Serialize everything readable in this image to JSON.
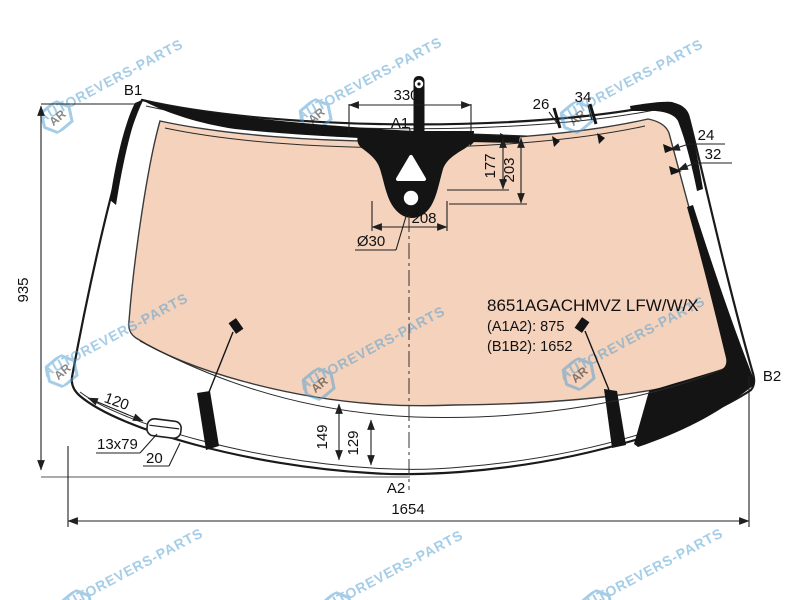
{
  "watermark": {
    "logo": "AR",
    "text": "AUTOREVERS-PARTS",
    "color": "#4D9DD0"
  },
  "part_info": {
    "part_number": "8651AGACHMVZ LFW/W/X",
    "a1a2": "(A1A2): 875",
    "b1b2": "(B1B2): 1652"
  },
  "points": {
    "b1": "B1",
    "b2": "B2",
    "a1": "A1",
    "a2": "A2"
  },
  "dimensions": {
    "height": "935",
    "width": "1654",
    "sensor_width": "330",
    "top_offset_1": "26",
    "top_offset_2": "34",
    "right_offset_1": "24",
    "right_offset_2": "32",
    "sensor_depth_1": "177",
    "sensor_depth_2": "203",
    "sensor_base": "208",
    "hole_diameter": "Ø30",
    "pad_offset": "120",
    "pad_size": "13x79",
    "pad_gap": "20",
    "bottom_offset_1": "149",
    "bottom_offset_2": "129"
  },
  "colors": {
    "glass_tint": "#F4D2BC",
    "frit_black": "#141414",
    "line": "#1F1F1F"
  }
}
